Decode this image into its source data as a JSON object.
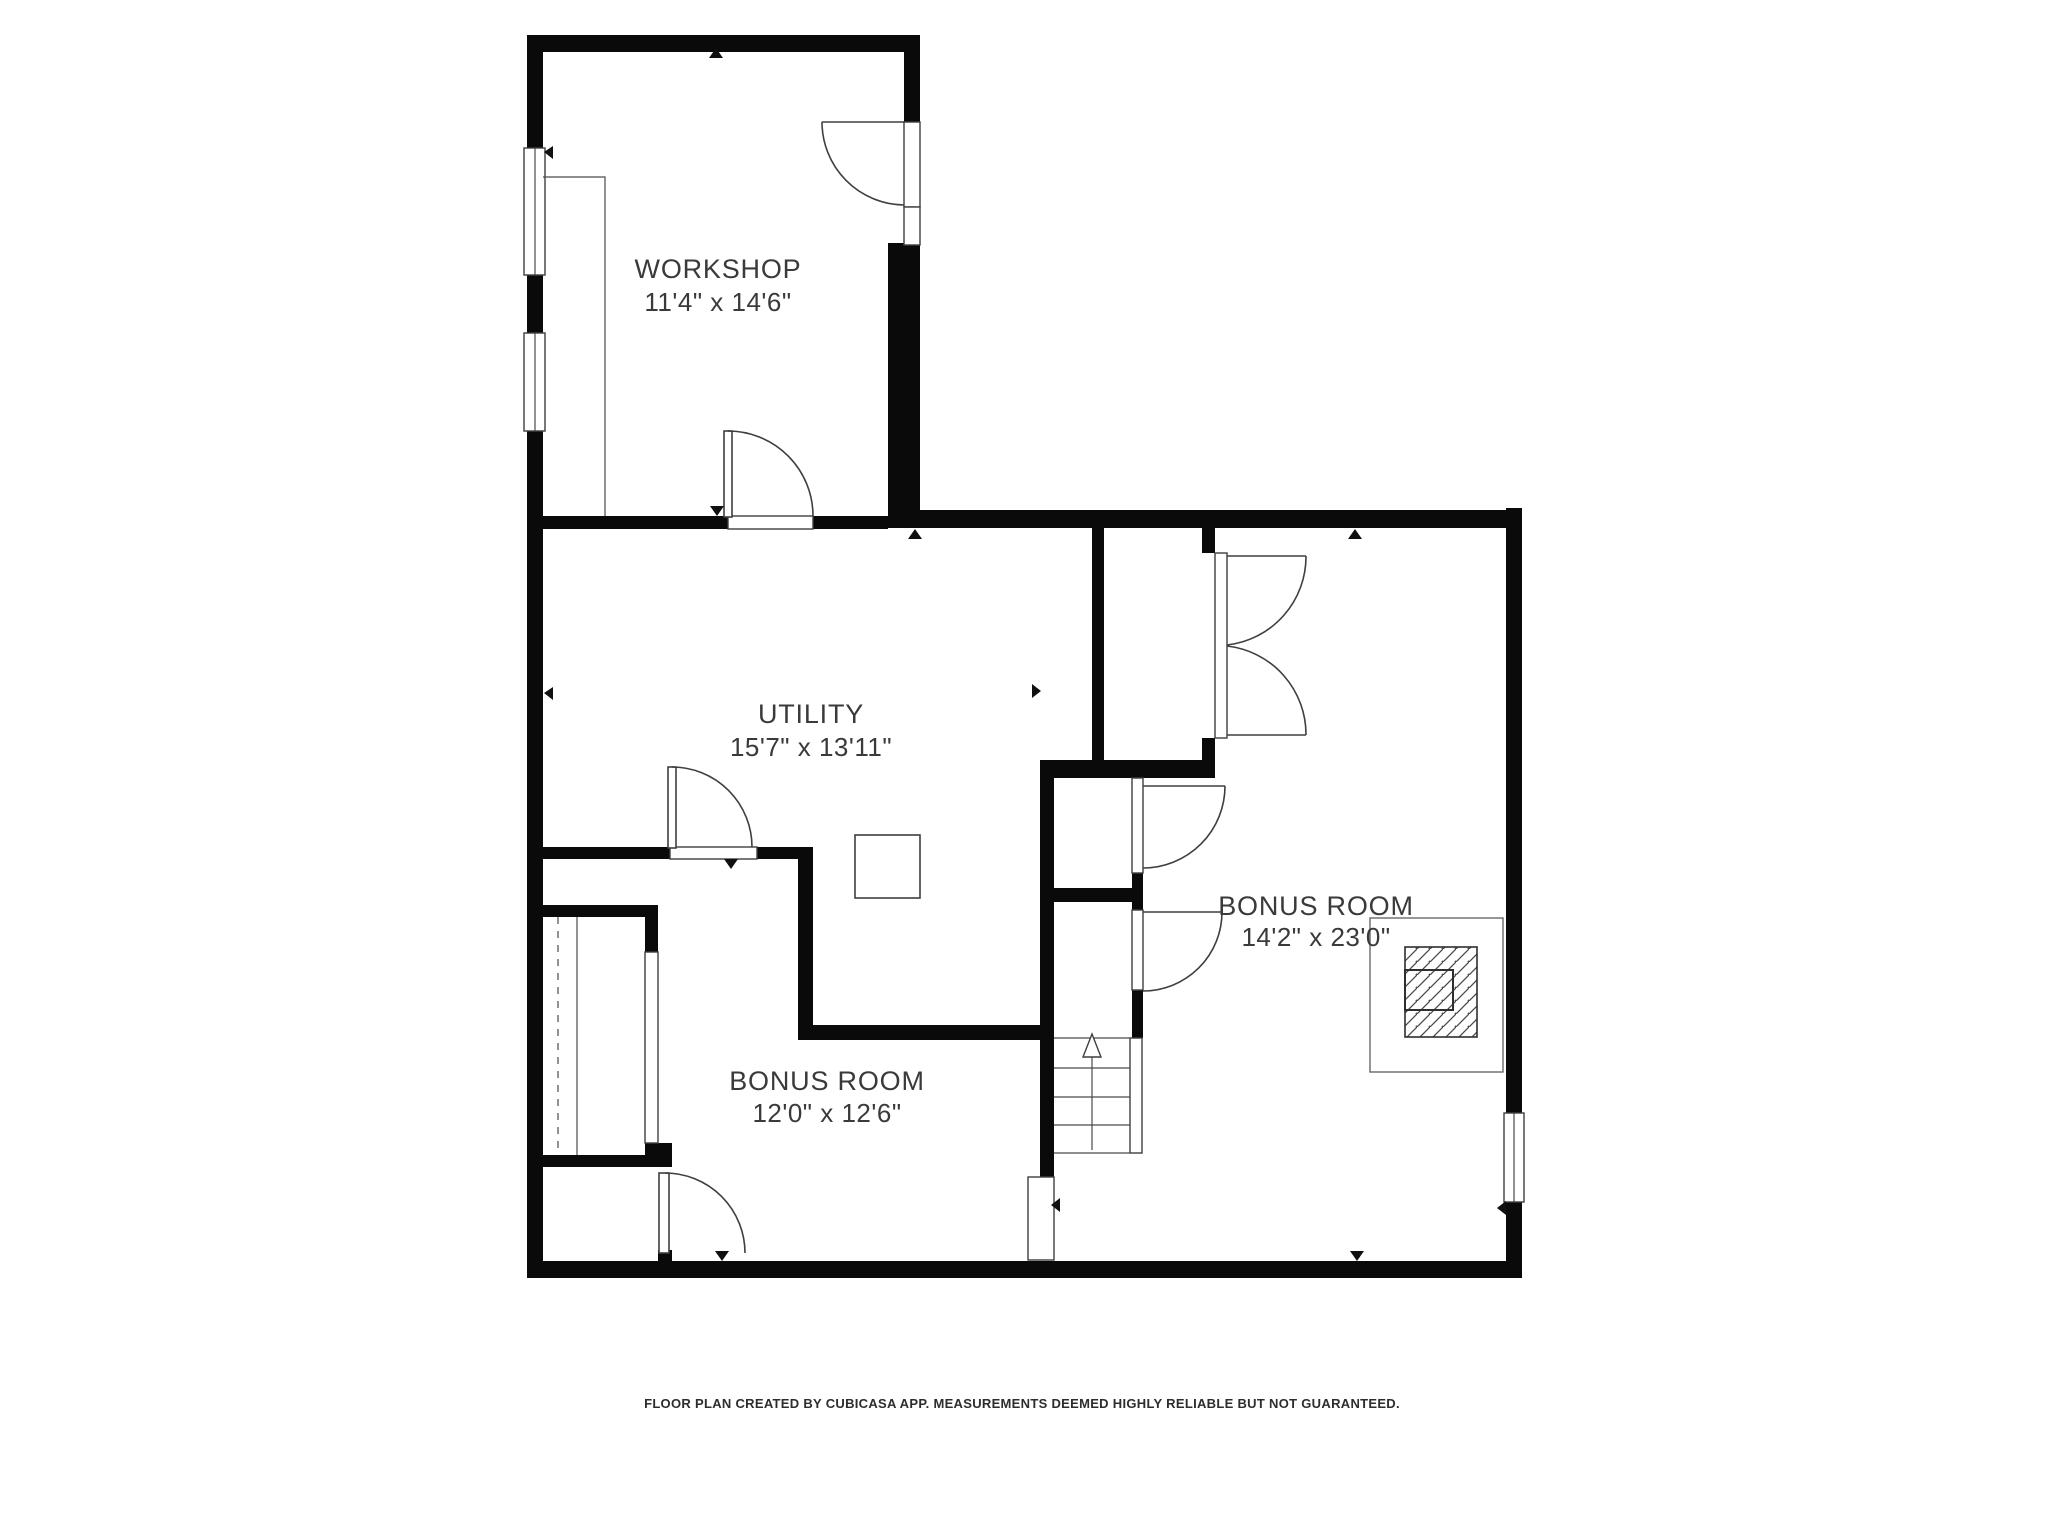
{
  "document": {
    "type": "floor-plan",
    "background_color": "#ffffff",
    "wall_color": "#0a0a0a",
    "line_color": "#3f3f3f",
    "label_color": "#3a3a3a"
  },
  "rooms": [
    {
      "name": "WORKSHOP",
      "dims": "11'4\" x 14'6\""
    },
    {
      "name": "UTILITY",
      "dims": "15'7\" x 13'11\""
    },
    {
      "name": "BONUS ROOM",
      "dims": "14'2\" x 23'0\""
    },
    {
      "name": "BONUS ROOM",
      "dims": "12'0\" x 12'6\""
    }
  ],
  "footer": {
    "text": "FLOOR PLAN CREATED BY CUBICASA APP. MEASUREMENTS DEEMED HIGHLY RELIABLE BUT NOT GUARANTEED."
  }
}
